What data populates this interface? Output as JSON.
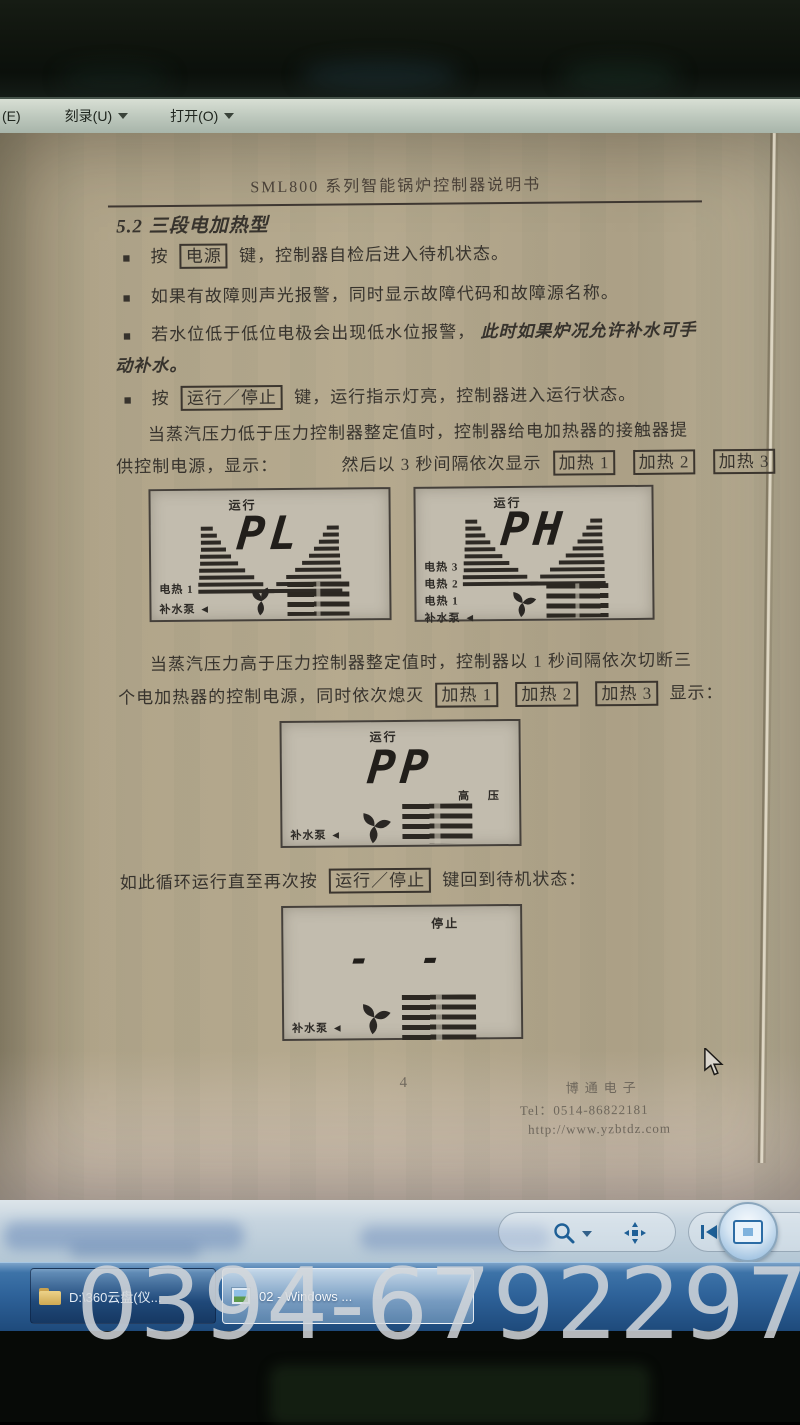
{
  "toolbar": {
    "partial_left": "(E)",
    "burn_label": "刻录(U)",
    "open_label": "打开(O)"
  },
  "doc": {
    "bullet_char": "■",
    "title": "SML800 系列智能锅炉控制器说明书",
    "heading": "5.2 三段电加热型",
    "b1_pre": "按",
    "b1_key": "电源",
    "b1_post": "键，控制器自检后进入待机状态。",
    "b2": "如果有故障则声光报警，同时显示故障代码和故障源名称。",
    "b3_normal": "若水位低于低位电极会出现低水位报警，",
    "b3_em1": "此时如果炉况允许补水可手",
    "b3_em2": "动补水。",
    "b4_pre": "按",
    "b4_key": "运行／停止",
    "b4_post": "键，运行指示灯亮，控制器进入运行状态。",
    "p1_line1": "当蒸汽压力低于压力控制器整定值时，控制器给电加热器的接触器提",
    "p1_line2_pre": "供控制电源，显示：",
    "p1_line2_mid": "然后以 3 秒间隔依次显示",
    "heat1": "加热 1",
    "heat2": "加热 2",
    "heat3": "加热 3",
    "p2_line1": "当蒸汽压力高于压力控制器整定值时，控制器以 1 秒间隔依次切断三",
    "p2_line2_pre": "个电加热器的控制电源，同时依次熄灭",
    "p2_line2_post": "显示：",
    "p3_pre": "如此循环运行直至再次按",
    "p3_key": "运行／停止",
    "p3_post": "键回到待机状态：",
    "page_number": "4",
    "footer_company": "博通电子",
    "footer_tel": "Tel：0514-86822181",
    "footer_url": "http://www.yzbtdz.com"
  },
  "lcd": {
    "p1": {
      "status": "运行",
      "value": "PL",
      "l1": "电热 1",
      "l2": "补水泵 ◄"
    },
    "p2": {
      "status": "运行",
      "value": "PH",
      "l1": "电热 3",
      "l2": "电热 2",
      "l3": "电热 1",
      "l4": "补水泵 ◄"
    },
    "p3": {
      "status": "运行",
      "value": "PP",
      "right": "高 压",
      "l1": "补水泵 ◄"
    },
    "p4": {
      "status": "停止",
      "value": "- -",
      "l1": "补水泵 ◄"
    }
  },
  "taskbar": {
    "task1": "D:\\360云盘(仪...",
    "task2": "02 - Windows ..."
  },
  "watermark": "0394-6792297"
}
